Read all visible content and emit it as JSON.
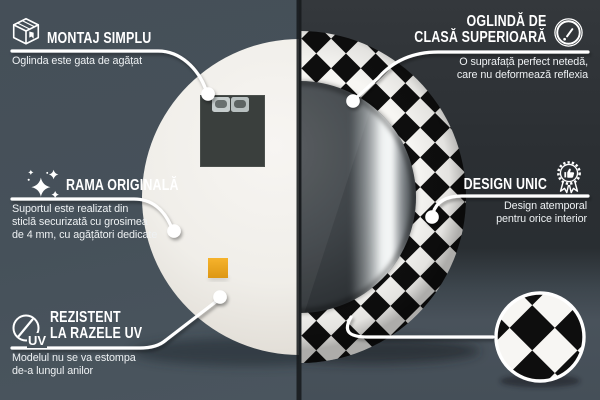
{
  "canvas": {
    "width": 600,
    "height": 400
  },
  "colors": {
    "bg_left": "#46515a",
    "bg_right_top": "#2b2f33",
    "bg_right_bottom": "#454f58",
    "text": "#ffffff",
    "checker_black": "#0e0e0e",
    "checker_white": "#f7f6f3",
    "mirror_back_white": "#f0eee9",
    "sticker_orange": "#efa81f",
    "hanging_plate_gray": "#3a3f3d",
    "connector_white": "#ffffff"
  },
  "icons": {
    "uv_label": "UV"
  },
  "callouts": {
    "montaj_simplu": {
      "icon": "package-icon",
      "title": "MONTAJ SIMPLU",
      "body": "Oglinda este gata de agățat"
    },
    "rama_originala": {
      "icon": "sparkles-icon",
      "title": "RAMA ORIGINALĂ",
      "body": "Suportul este realizat din\nsticlă securizată cu grosimea\nde 4 mm, cu agățători dedicate"
    },
    "rezistent_uv": {
      "icon": "uv-sun-icon",
      "title": "REZISTENT\nLA RAZELE UV",
      "body": "Modelul nu se va estompa\nde-a lungul anilor"
    },
    "oglinda_clasa": {
      "icon": "mirror-icon",
      "title": "OGLINDĂ DE\nCLASĂ SUPERIOARĂ",
      "body": "O suprafață perfect netedă,\ncare nu deformează reflexia"
    },
    "design_unic": {
      "icon": "award-badge-icon",
      "title": "DESIGN UNIC",
      "body": "Design atemporal\npentru orice interior"
    }
  },
  "product": {
    "kind": "round decorative wall mirror, split view (back / front)",
    "frame_pattern": "black and white harlequin diamond checker",
    "detail_zoom": "magnified checker pattern swatch"
  }
}
